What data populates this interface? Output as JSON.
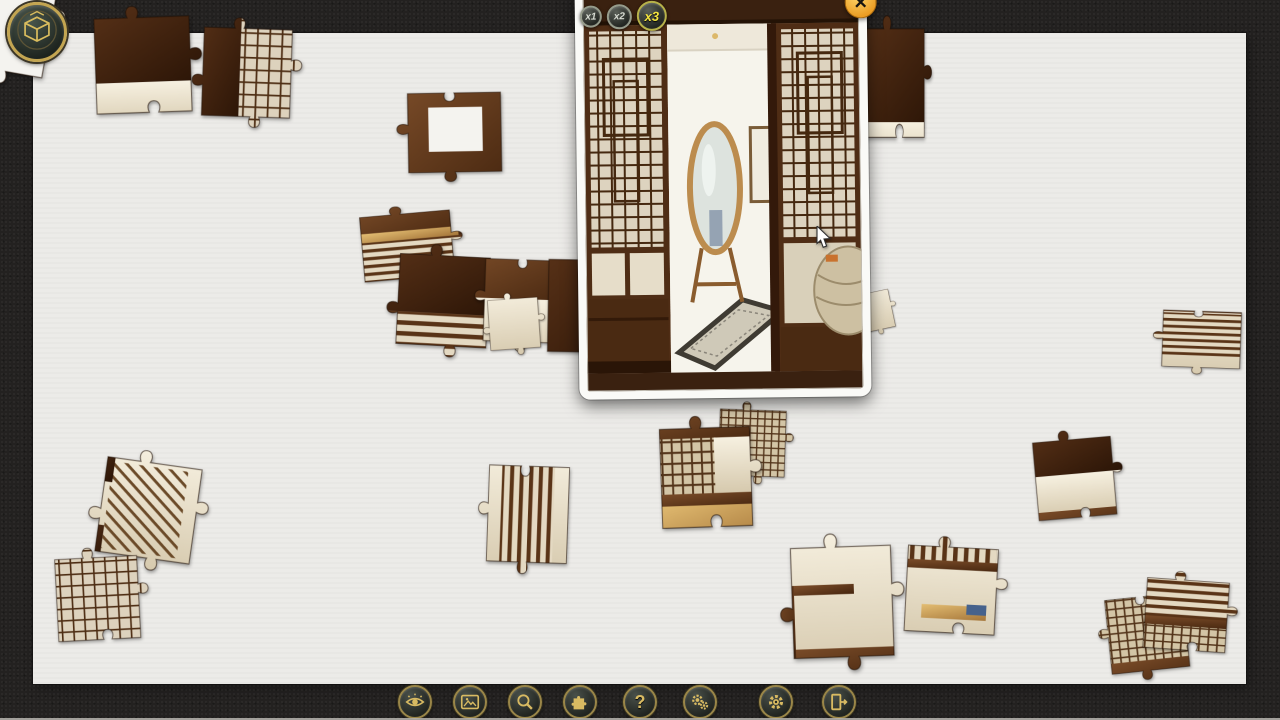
{
  "window": {
    "width": 1280,
    "height": 720
  },
  "colors": {
    "background": "#232120",
    "board": "#ecebe8",
    "gold_icon": "#d8ba62",
    "button_ring": "#9a8648",
    "close_button_orange": "#f0a42e",
    "active_zoom_label": "#f2e33f",
    "piece_dark_wood": "#4e2b15",
    "piece_cream": "#e9dfc9"
  },
  "logo": {
    "icon": "cube-icon"
  },
  "preview": {
    "close_label": "✕",
    "zoom_options": [
      {
        "label": "x1",
        "active": false,
        "size": 22
      },
      {
        "label": "x2",
        "active": false,
        "size": 25
      },
      {
        "label": "x3",
        "active": true,
        "size": 30
      }
    ]
  },
  "toolbar": {
    "buttons": [
      {
        "name": "eye-button",
        "icon": "icon-eye",
        "x": 415
      },
      {
        "name": "picture-button",
        "icon": "icon-picture",
        "x": 470
      },
      {
        "name": "magnifier-button",
        "icon": "icon-magnifier",
        "x": 525
      },
      {
        "name": "puzzle-piece-button",
        "icon": "icon-puzzle",
        "x": 580
      },
      {
        "name": "question-button",
        "icon": "icon-question",
        "x": 640,
        "glyph": "?"
      },
      {
        "name": "gears-button",
        "icon": "icon-gears",
        "x": 700
      },
      {
        "name": "gear-button",
        "icon": "icon-gear",
        "x": 776
      },
      {
        "name": "exit-button",
        "icon": "icon-exit",
        "x": 839
      }
    ]
  },
  "cursor": {
    "x": 816,
    "y": 226
  },
  "fills": {
    "wood": "url(#g-wood)",
    "wood2": "url(#g-wood2)",
    "cream": "url(#g-cream)",
    "white": "#f4f3ef",
    "lat": "url(#p-lat)",
    "lat2": "url(#p-lat2)",
    "hstripe": "url(#p-hstripe)",
    "vstripe": "url(#p-vstripe)",
    "gold": "url(#g-gold)",
    "diag": "url(#p-diag)",
    "blue": "#46628c"
  },
  "pieces": [
    {
      "shape": "pz3",
      "x": -52,
      "y": -56,
      "s": 1.05,
      "rot": 10,
      "layers": [
        {
          "f": "white",
          "x": -8,
          "y": -8,
          "w": 136,
          "h": 136
        }
      ]
    },
    {
      "shape": "pz1",
      "x": 84,
      "y": 10,
      "s": 0.95,
      "rot": -2,
      "layers": [
        {
          "f": "wood",
          "x": -8,
          "y": -8,
          "w": 136,
          "h": 86
        },
        {
          "f": "cream",
          "x": -8,
          "y": 78,
          "w": 136,
          "h": 50
        }
      ]
    },
    {
      "shape": "pz3",
      "x": 196,
      "y": 18,
      "s": 0.88,
      "rot": 2,
      "layers": [
        {
          "f": "wood",
          "x": -8,
          "y": -8,
          "w": 60,
          "h": 136
        },
        {
          "f": "lat",
          "x": 52,
          "y": -8,
          "w": 76,
          "h": 136
        }
      ]
    },
    {
      "shape": "pz2",
      "x": 398,
      "y": 86,
      "s": 0.93,
      "sy": 0.85,
      "rot": -1,
      "layers": [
        {
          "f": "wood2",
          "x": -8,
          "y": -8,
          "w": 136,
          "h": 136
        },
        {
          "f": "white",
          "x": 32,
          "y": 28,
          "w": 58,
          "h": 56
        }
      ]
    },
    {
      "shape": "pz1",
      "x": 856,
      "y": 18,
      "s": 0.62,
      "sy": 1.75,
      "rot": 0,
      "layers": [
        {
          "f": "wood",
          "x": -8,
          "y": -8,
          "w": 136,
          "h": 110
        },
        {
          "f": "cream",
          "x": -8,
          "y": 96,
          "w": 136,
          "h": 40
        }
      ]
    },
    {
      "shape": "pz1",
      "x": 350,
      "y": 212,
      "s": 0.9,
      "sy": 0.72,
      "rot": -5,
      "layers": [
        {
          "f": "wood2",
          "x": -8,
          "y": -8,
          "w": 136,
          "h": 58
        },
        {
          "f": "gold",
          "x": 10,
          "y": 36,
          "w": 108,
          "h": 14
        },
        {
          "f": "hstripe",
          "x": -8,
          "y": 50,
          "w": 136,
          "h": 78
        }
      ]
    },
    {
      "shape": "pz3",
      "x": 392,
      "y": 244,
      "s": 0.9,
      "rot": 3,
      "layers": [
        {
          "f": "wood",
          "x": -8,
          "y": -8,
          "w": 136,
          "h": 82
        },
        {
          "f": "hstripe",
          "x": -8,
          "y": 74,
          "w": 136,
          "h": 54
        }
      ]
    },
    {
      "shape": "pz2",
      "x": 478,
      "y": 250,
      "s": 0.82,
      "rot": 2,
      "layers": [
        {
          "f": "wood2",
          "x": -8,
          "y": -8,
          "w": 136,
          "h": 66
        },
        {
          "f": "cream",
          "x": -8,
          "y": 58,
          "w": 136,
          "h": 70
        }
      ]
    },
    {
      "shape": "pz1",
      "x": 540,
      "y": 250,
      "s": 0.92,
      "rot": 1,
      "layers": [
        {
          "f": "wood",
          "x": -8,
          "y": -8,
          "w": 136,
          "h": 136
        }
      ]
    },
    {
      "shape": "pz3",
      "x": 482,
      "y": 296,
      "s": 0.5,
      "rot": -4,
      "layers": [
        {
          "f": "cream",
          "x": -8,
          "y": -8,
          "w": 136,
          "h": 136
        }
      ]
    },
    {
      "shape": "pz3",
      "x": 714,
      "y": 402,
      "s": 0.66,
      "rot": 2,
      "layers": [
        {
          "f": "lat2",
          "x": -8,
          "y": -8,
          "w": 136,
          "h": 136
        }
      ]
    },
    {
      "shape": "pz1",
      "x": 650,
      "y": 420,
      "s": 0.9,
      "sy": 1.1,
      "rot": -2,
      "layers": [
        {
          "f": "wood2",
          "x": -8,
          "y": -8,
          "w": 136,
          "h": 30
        },
        {
          "f": "lat2",
          "x": -8,
          "y": 20,
          "w": 80,
          "h": 58
        },
        {
          "f": "cream",
          "x": 70,
          "y": 20,
          "w": 58,
          "h": 58
        },
        {
          "f": "wood2",
          "x": -8,
          "y": 76,
          "w": 136,
          "h": 14
        },
        {
          "f": "gold",
          "x": -8,
          "y": 88,
          "w": 136,
          "h": 40
        }
      ]
    },
    {
      "shape": "pz3",
      "x": 100,
      "y": 446,
      "s": 0.95,
      "rot": 8,
      "layers": [
        {
          "f": "cream",
          "x": -8,
          "y": -8,
          "w": 136,
          "h": 136
        },
        {
          "f": "diag",
          "x": 16,
          "y": 14,
          "w": 80,
          "h": 92
        },
        {
          "f": "wood",
          "x": -8,
          "y": -8,
          "w": 26,
          "h": 44
        },
        {
          "f": "wood",
          "x": -8,
          "y": 82,
          "w": 24,
          "h": 46
        }
      ]
    },
    {
      "shape": "pz1",
      "x": 46,
      "y": 552,
      "s": 0.82,
      "rot": -3,
      "layers": [
        {
          "f": "lat",
          "x": -8,
          "y": -8,
          "w": 136,
          "h": 136
        }
      ]
    },
    {
      "shape": "pz2",
      "x": 482,
      "y": 455,
      "s": 0.8,
      "sy": 1.2,
      "rot": 2,
      "layers": [
        {
          "f": "cream",
          "x": -8,
          "y": -8,
          "w": 136,
          "h": 136
        },
        {
          "f": "vstripe",
          "x": 26,
          "y": -8,
          "w": 66,
          "h": 136
        }
      ]
    },
    {
      "shape": "pz1",
      "x": 1024,
      "y": 436,
      "s": 0.78,
      "rot": -5,
      "layers": [
        {
          "f": "wood",
          "x": -8,
          "y": -8,
          "w": 136,
          "h": 62
        },
        {
          "f": "cream",
          "x": -8,
          "y": 54,
          "w": 136,
          "h": 54
        },
        {
          "f": "wood2",
          "x": -8,
          "y": 100,
          "w": 136,
          "h": 28
        }
      ]
    },
    {
      "shape": "pz2",
      "x": 1156,
      "y": 304,
      "s": 0.78,
      "sy": 0.72,
      "rot": 2,
      "layers": [
        {
          "f": "cream",
          "x": -8,
          "y": -8,
          "w": 136,
          "h": 136
        },
        {
          "f": "wood2",
          "x": -8,
          "y": -8,
          "w": 136,
          "h": 20
        },
        {
          "f": "hstripe",
          "x": -8,
          "y": 14,
          "w": 136,
          "h": 76
        }
      ]
    },
    {
      "shape": "pz3",
      "x": 780,
      "y": 538,
      "s": 1.0,
      "sy": 1.1,
      "rot": -2,
      "layers": [
        {
          "f": "cream",
          "x": -8,
          "y": -8,
          "w": 136,
          "h": 136
        },
        {
          "f": "wood2",
          "x": -8,
          "y": 102,
          "w": 136,
          "h": 26
        },
        {
          "f": "wood2",
          "x": -8,
          "y": 44,
          "w": 20,
          "h": 70
        },
        {
          "f": "wood2",
          "x": 12,
          "y": 44,
          "w": 60,
          "h": 9
        }
      ]
    },
    {
      "shape": "pz1",
      "x": 900,
      "y": 536,
      "s": 0.9,
      "sy": 0.95,
      "rot": 3,
      "layers": [
        {
          "f": "cream",
          "x": -8,
          "y": -8,
          "w": 136,
          "h": 136
        },
        {
          "f": "vstripe",
          "x": 2,
          "y": -8,
          "w": 106,
          "h": 36
        },
        {
          "f": "wood2",
          "x": -8,
          "y": 26,
          "w": 136,
          "h": 10
        },
        {
          "f": "gold",
          "x": 28,
          "y": 78,
          "w": 72,
          "h": 16
        },
        {
          "f": "blue",
          "x": 78,
          "y": 76,
          "w": 22,
          "h": 12
        }
      ]
    },
    {
      "shape": "pz2",
      "x": 1096,
      "y": 594,
      "s": 0.78,
      "sy": 0.95,
      "rot": -6,
      "layers": [
        {
          "f": "lat2",
          "x": -8,
          "y": -8,
          "w": 136,
          "h": 136
        },
        {
          "f": "wood2",
          "x": -8,
          "y": 96,
          "w": 136,
          "h": 32
        }
      ]
    },
    {
      "shape": "pz1",
      "x": 1140,
      "y": 570,
      "s": 0.82,
      "sy": 0.85,
      "rot": 4,
      "layers": [
        {
          "f": "hstripe",
          "x": -8,
          "y": -8,
          "w": 136,
          "h": 78
        },
        {
          "f": "wood2",
          "x": -8,
          "y": 64,
          "w": 136,
          "h": 12
        },
        {
          "f": "lat2",
          "x": -8,
          "y": 76,
          "w": 136,
          "h": 52
        }
      ]
    },
    {
      "shape": "pz3",
      "x": 846,
      "y": 294,
      "s": 0.38,
      "rot": -12,
      "layers": [
        {
          "f": "cream",
          "x": -8,
          "y": -8,
          "w": 136,
          "h": 136
        }
      ]
    }
  ]
}
